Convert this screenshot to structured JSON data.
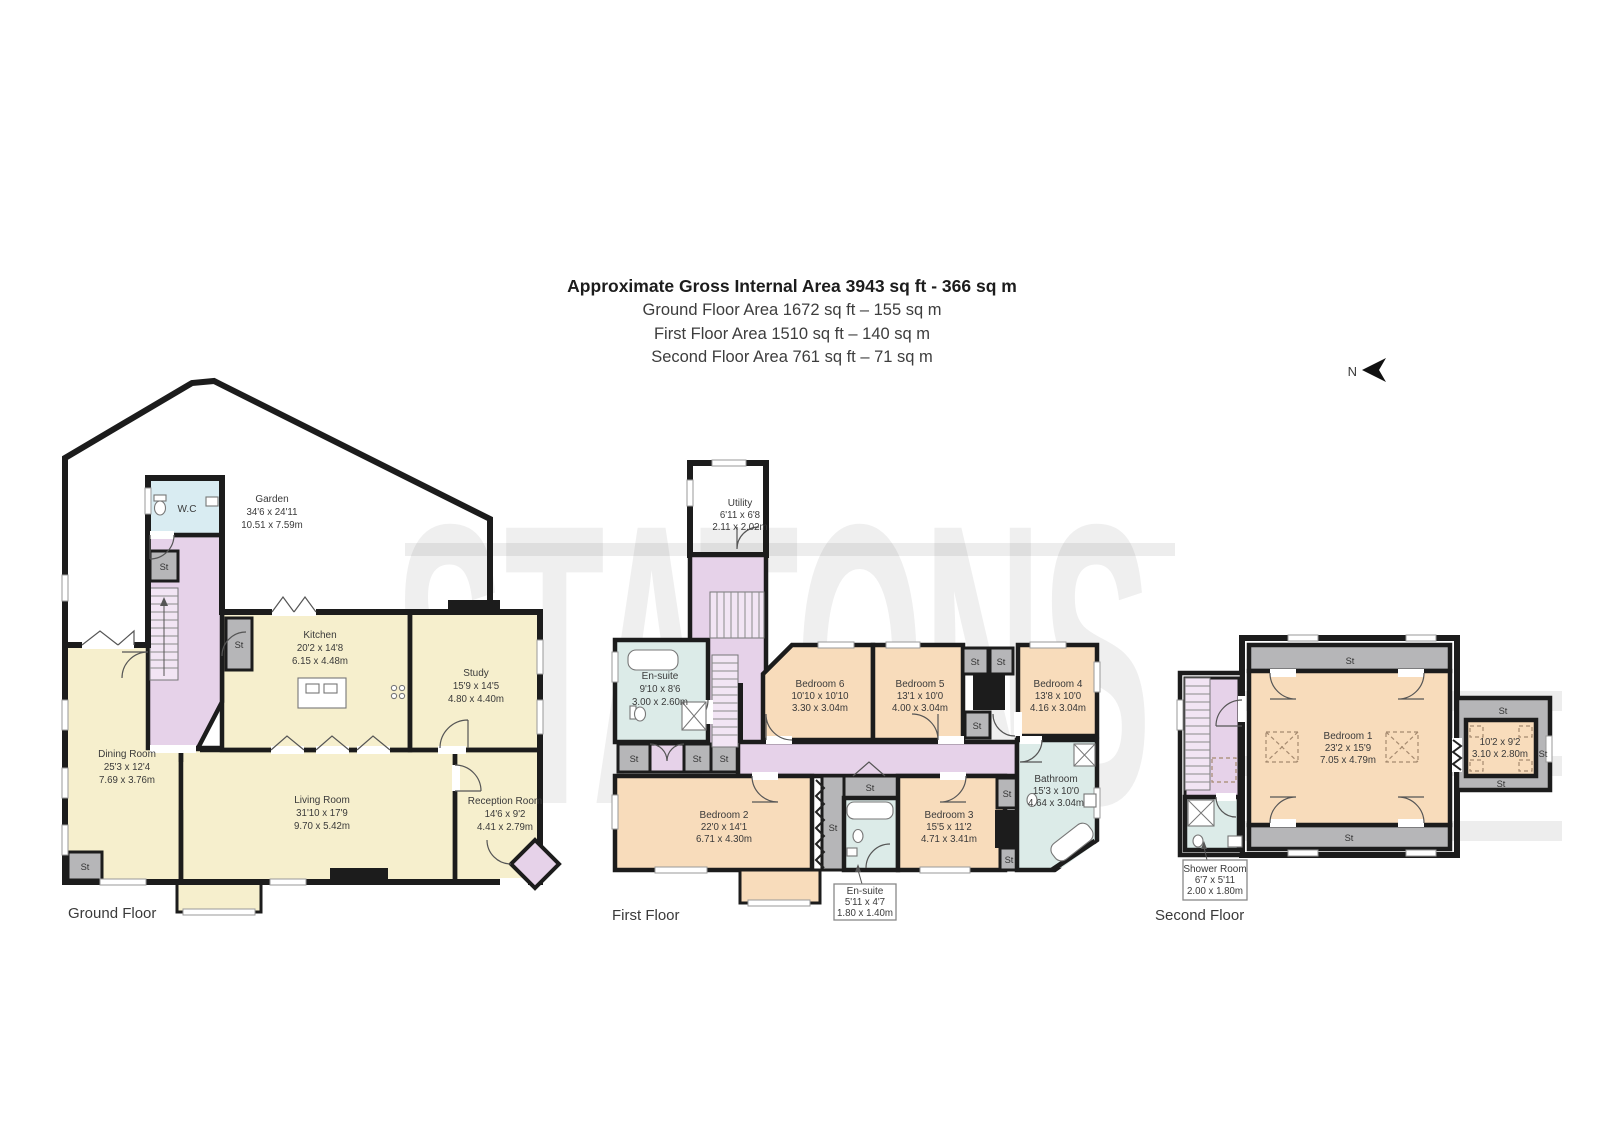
{
  "header": {
    "title": "Approximate Gross Internal Area 3943 sq ft - 366 sq m",
    "ground": "Ground Floor Area 1672 sq ft – 155 sq m",
    "first": "First Floor Area 1510 sq ft – 140 sq m",
    "second": "Second Floor Area 761 sq ft – 71 sq m"
  },
  "compass": {
    "label": "N"
  },
  "watermark": "STATONS",
  "st": "St",
  "colors": {
    "room_yellow": "#f6efcd",
    "bedroom_peach": "#f8dcbb",
    "hall_purple": "#e6d2e9",
    "stairs_purple": "#f2e5f4",
    "bath_blue": "#dcebe8",
    "wc_blue": "#d9ecf2",
    "garden_green": "#dce6c8",
    "storage_grey": "#b6b6b8",
    "wall": "#1c1c1c"
  },
  "ground_floor": {
    "caption": "Ground Floor",
    "rooms": {
      "garden": {
        "name": "Garden",
        "ft": "34'6 x 24'11",
        "m": "10.51 x 7.59m"
      },
      "wc": {
        "name": "W.C"
      },
      "kitchen": {
        "name": "Kitchen",
        "ft": "20'2 x 14'8",
        "m": "6.15 x 4.48m"
      },
      "study": {
        "name": "Study",
        "ft": "15'9 x 14'5",
        "m": "4.80 x 4.40m"
      },
      "dining": {
        "name": "Dining Room",
        "ft": "25'3 x 12'4",
        "m": "7.69 x 3.76m"
      },
      "living": {
        "name": "Living Room",
        "ft": "31'10 x 17'9",
        "m": "9.70 x 5.42m"
      },
      "reception": {
        "name": "Reception Room",
        "ft": "14'6 x 9'2",
        "m": "4.41 x 2.79m"
      }
    }
  },
  "first_floor": {
    "caption": "First Floor",
    "rooms": {
      "utility": {
        "name": "Utility",
        "ft": "6'11 x 6'8",
        "m": "2.11 x 2.02m"
      },
      "ensuite": {
        "name": "En-suite",
        "ft": "9'10 x 8'6",
        "m": "3.00 x 2.60m"
      },
      "bedroom6": {
        "name": "Bedroom 6",
        "ft": "10'10 x 10'10",
        "m": "3.30 x 3.04m"
      },
      "bedroom5": {
        "name": "Bedroom 5",
        "ft": "13'1 x 10'0",
        "m": "4.00 x 3.04m"
      },
      "bedroom4": {
        "name": "Bedroom 4",
        "ft": "13'8 x 10'0",
        "m": "4.16 x 3.04m"
      },
      "bedroom2": {
        "name": "Bedroom 2",
        "ft": "22'0 x 14'1",
        "m": "6.71 x 4.30m"
      },
      "bedroom3": {
        "name": "Bedroom 3",
        "ft": "15'5 x 11'2",
        "m": "4.71 x 3.41m"
      },
      "bathroom": {
        "name": "Bathroom",
        "ft": "15'3 x 10'0",
        "m": "4.64 x 3.04m"
      },
      "ensuite2": {
        "name": "En-suite",
        "ft": "5'11 x 4'7",
        "m": "1.80 x 1.40m"
      }
    }
  },
  "second_floor": {
    "caption": "Second Floor",
    "rooms": {
      "bedroom1": {
        "name": "Bedroom 1",
        "ft": "23'2 x 15'9",
        "m": "7.05 x 4.79m"
      },
      "eaves_room": {
        "ft": "10'2 x 9'2",
        "m": "3.10 x 2.80m"
      },
      "shower": {
        "name": "Shower Room",
        "ft": "6'7 x 5'11",
        "m": "2.00 x 1.80m"
      }
    }
  }
}
